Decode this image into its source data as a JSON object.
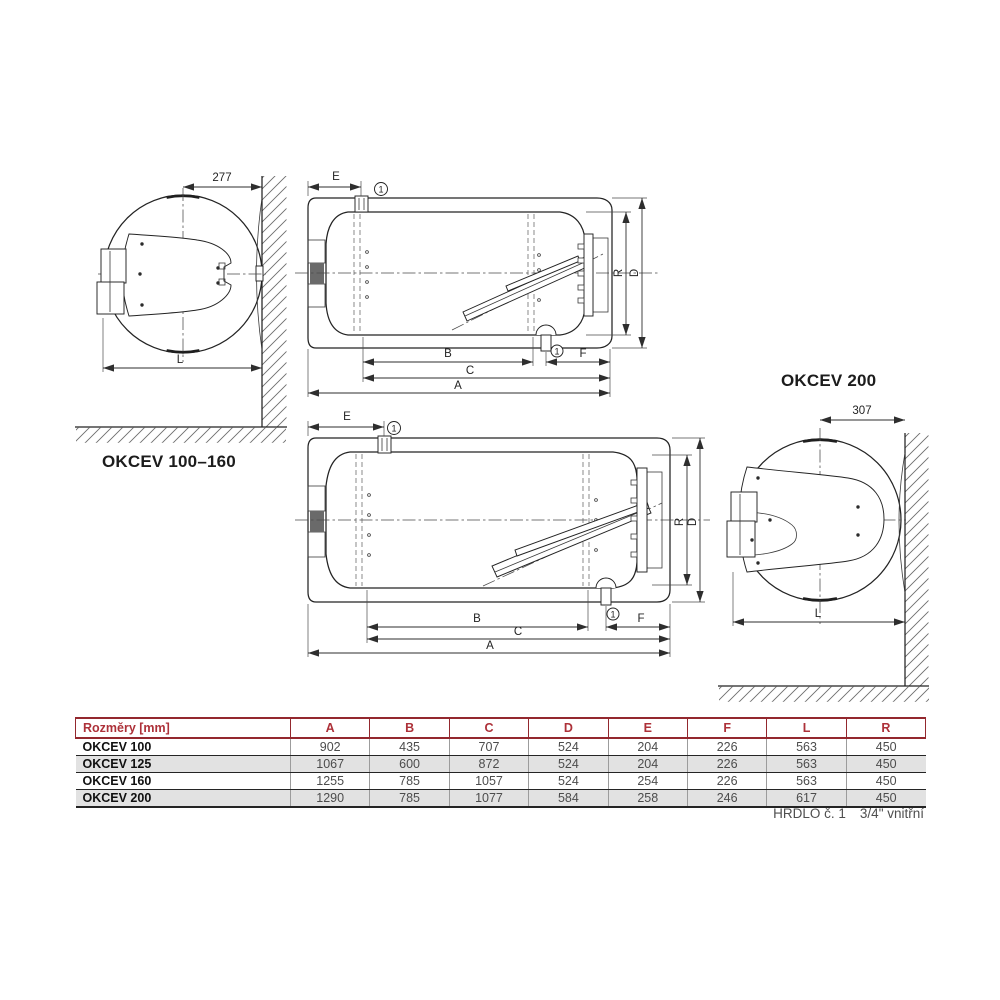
{
  "drawings": {
    "end_view_small": {
      "caption": "OKCEV 100–160",
      "offset_dim": "277",
      "width_dim": "L"
    },
    "section_small": {
      "dim_e": "E",
      "dim_b": "B",
      "dim_c": "C",
      "dim_a": "A",
      "dim_f": "F",
      "dim_r": "R",
      "dim_d": "D",
      "port_marker": "1"
    },
    "section_large": {
      "dim_e": "E",
      "dim_b": "B",
      "dim_c": "C",
      "dim_a": "A",
      "dim_f": "F",
      "dim_r": "R",
      "dim_d": "D",
      "port_marker": "1"
    },
    "end_view_large": {
      "caption": "OKCEV 200",
      "offset_dim": "307",
      "width_dim": "L"
    }
  },
  "table": {
    "header": [
      "Rozměry [mm]",
      "A",
      "B",
      "C",
      "D",
      "E",
      "F",
      "L",
      "R"
    ],
    "rows": [
      {
        "name": "OKCEV 100",
        "values": [
          "902",
          "435",
          "707",
          "524",
          "204",
          "226",
          "563",
          "450"
        ]
      },
      {
        "name": "OKCEV 125",
        "values": [
          "1067",
          "600",
          "872",
          "524",
          "204",
          "226",
          "563",
          "450"
        ]
      },
      {
        "name": "OKCEV 160",
        "values": [
          "1255",
          "785",
          "1057",
          "524",
          "254",
          "226",
          "563",
          "450"
        ]
      },
      {
        "name": "OKCEV 200",
        "values": [
          "1290",
          "785",
          "1077",
          "584",
          "258",
          "246",
          "617",
          "450"
        ]
      }
    ],
    "accent_color": "#a8333b"
  },
  "footnote": {
    "label": "HRDLO č. 1",
    "value": "3/4\" vnitřní"
  }
}
